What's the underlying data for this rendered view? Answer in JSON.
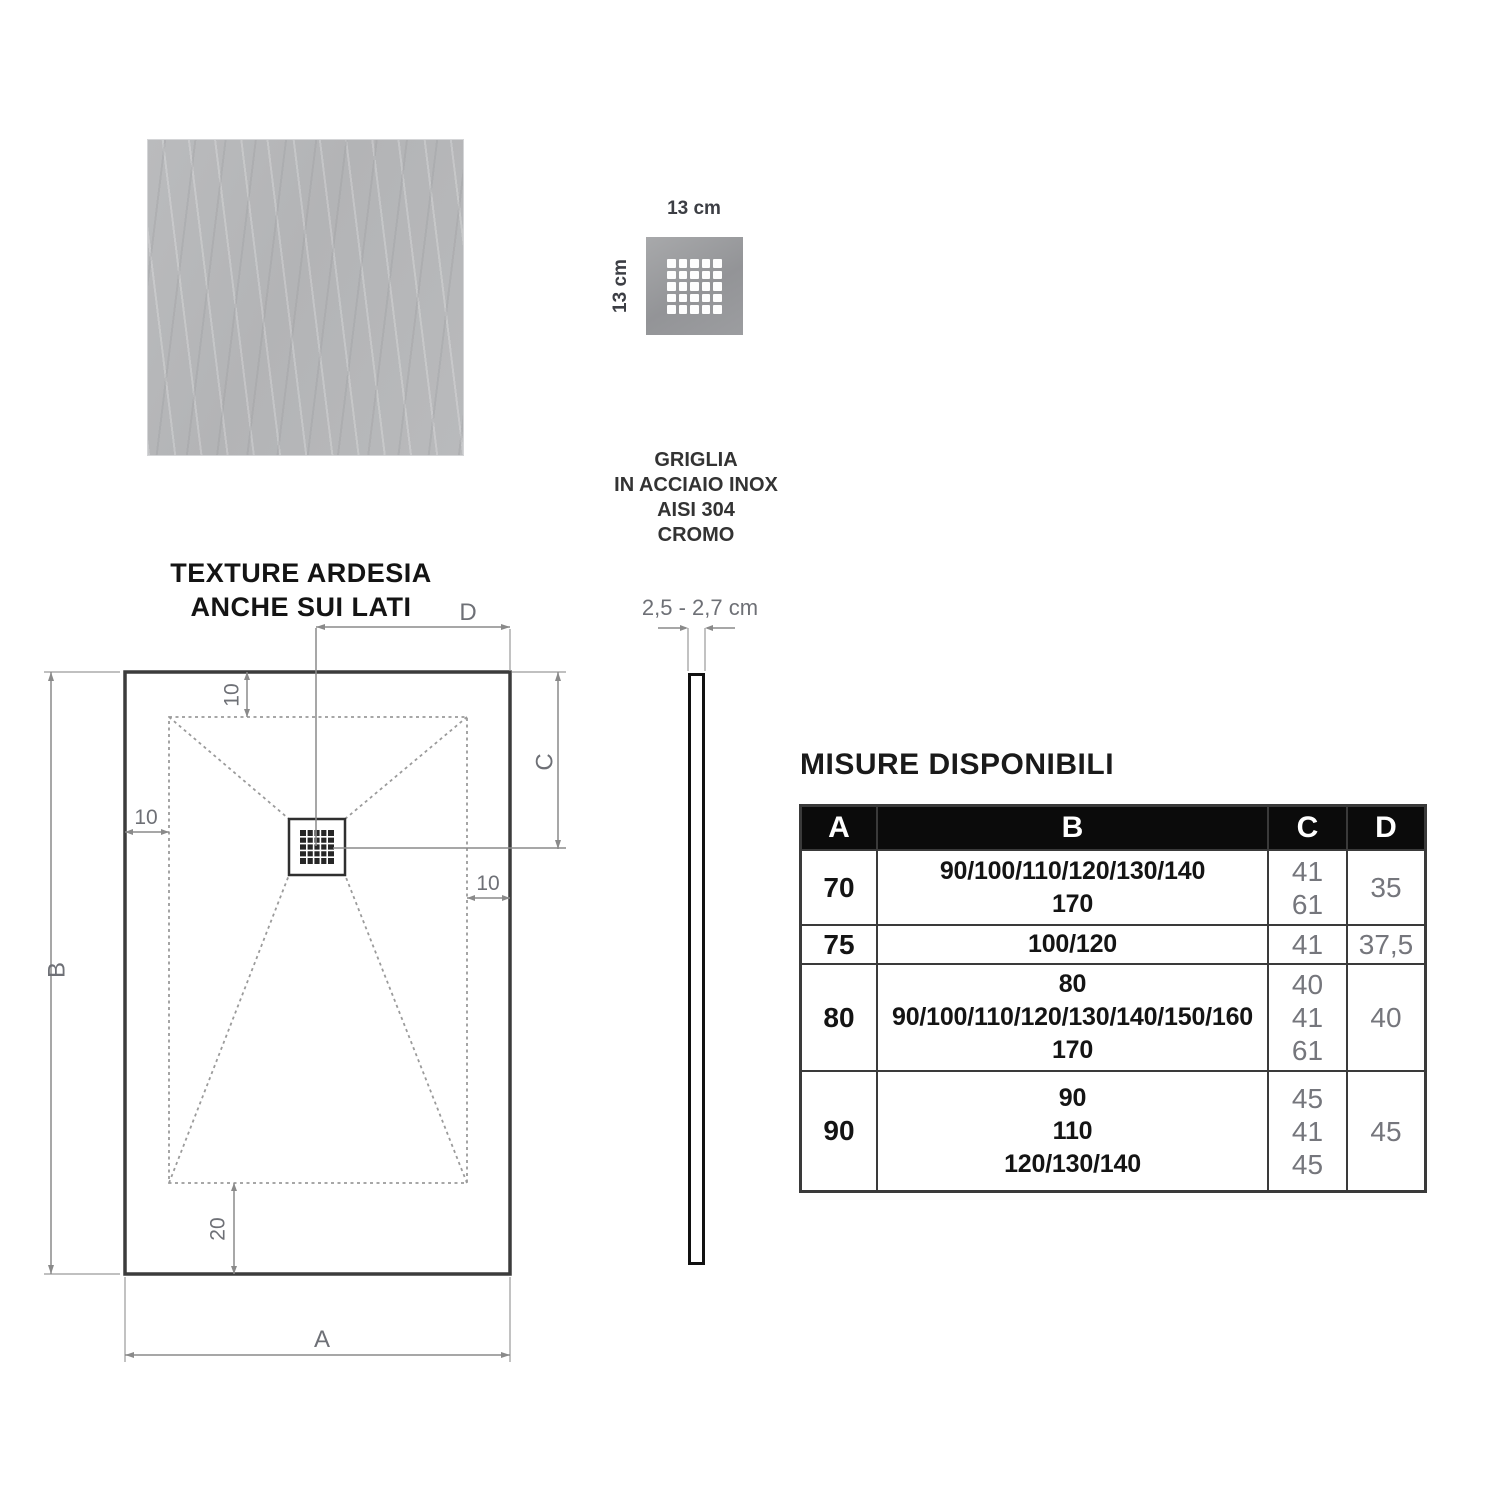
{
  "colors": {
    "background": "#ffffff",
    "texture_gray": "#b6b7b9",
    "grille_gray": "#9b9c9e",
    "ink": "#141414",
    "dimension_line_gray": "#8a8a8a",
    "dimension_label_gray": "#6e7076",
    "table_header_bg": "#0b0b0b",
    "table_header_text": "#ffffff",
    "table_border": "#3a3a3a",
    "table_value_gray": "#75767c"
  },
  "texture_sample": {
    "caption": [
      "TEXTURE ARDESIA",
      "ANCHE SUI LATI"
    ]
  },
  "grille": {
    "width_label": "13 cm",
    "height_label": "13 cm",
    "caption": [
      "GRIGLIA",
      "IN ACCIAIO INOX",
      "AISI 304",
      "CROMO"
    ]
  },
  "plan_view": {
    "dim_labels": {
      "width": "A",
      "height": "B",
      "drain_from_top": "C",
      "drain_from_right": "D",
      "inset_top": "10",
      "inset_left": "10",
      "inset_right": "10",
      "inset_bottom": "20"
    }
  },
  "profile_view": {
    "thickness_label": "2,5 - 2,7 cm"
  },
  "sizes_table": {
    "title": "MISURE DISPONIBILI",
    "headers": [
      "A",
      "B",
      "C",
      "D"
    ],
    "rows": [
      {
        "a": "70",
        "b": [
          "90/100/110/120/130/140",
          "170"
        ],
        "c": [
          "41",
          "61"
        ],
        "d": "35"
      },
      {
        "a": "75",
        "b": [
          "100/120"
        ],
        "c": [
          "41"
        ],
        "d": "37,5"
      },
      {
        "a": "80",
        "b": [
          "80",
          "90/100/110/120/130/140/150/160",
          "170"
        ],
        "c": [
          "40",
          "41",
          "61"
        ],
        "d": "40"
      },
      {
        "a": "90",
        "b": [
          "90",
          "110",
          "120/130/140"
        ],
        "c": [
          "45",
          "41",
          "45"
        ],
        "d": "45"
      }
    ]
  }
}
